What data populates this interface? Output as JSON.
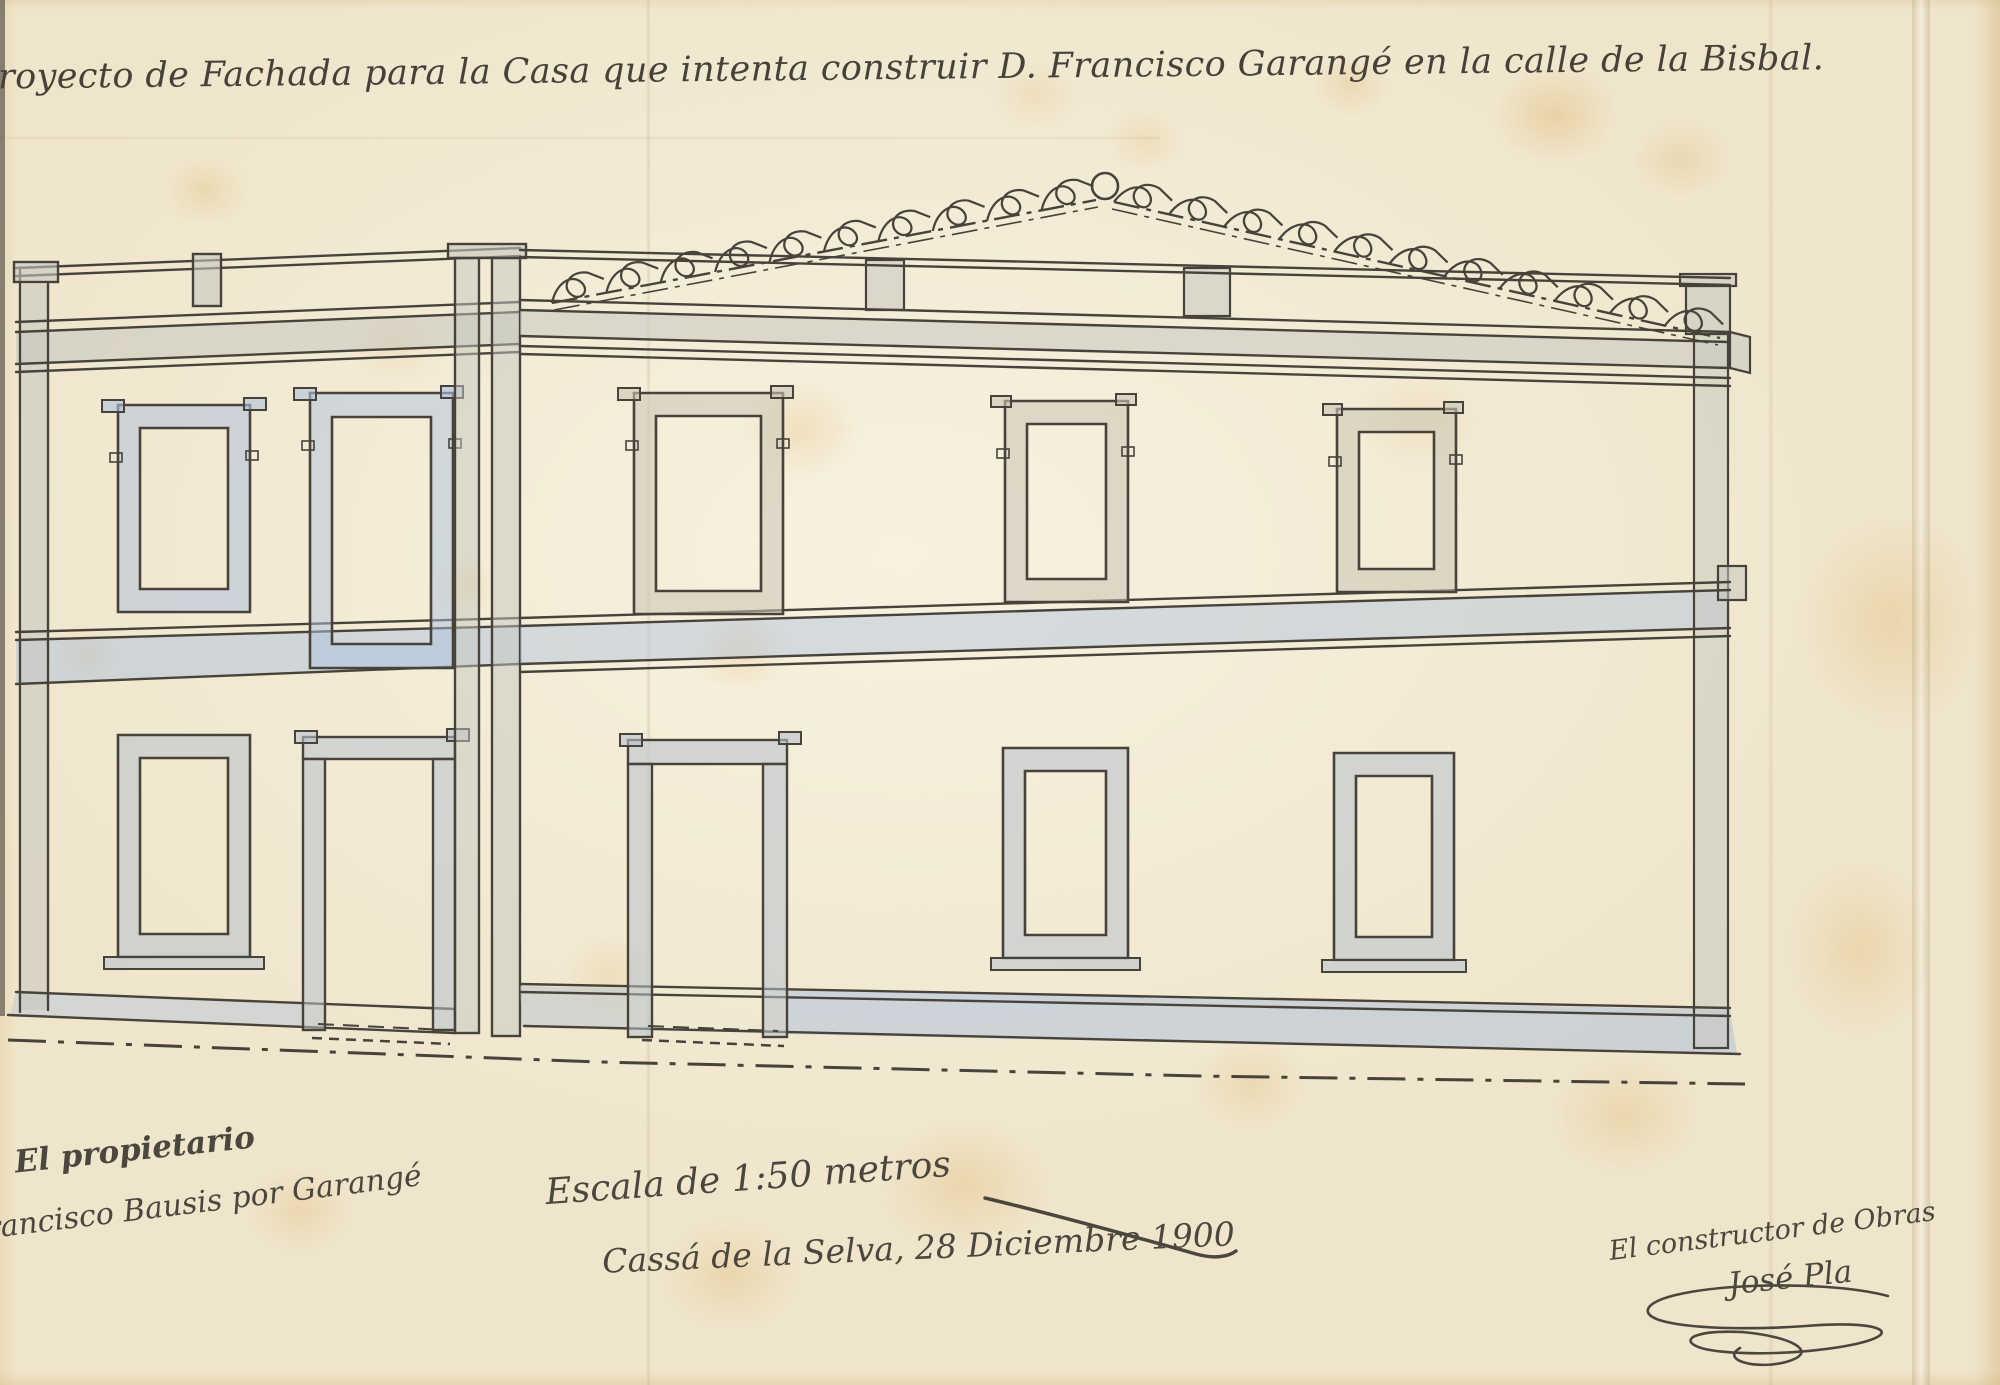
{
  "document": {
    "title": "Proyecto de Fachada para la Casa que intenta construir D. Francisco Garangé en la calle de la Bisbal.",
    "annotations": {
      "owner_role": "El propietario",
      "owner_signature": "Francisco Bausis por Garangé",
      "scale": "Escala de 1:50 metros",
      "place_date": "Cassá de la Selva, 28 Diciembre 1900",
      "builder_role": "El constructor de Obras",
      "builder_signature": "José Pla"
    },
    "colors": {
      "paper": "#efe5cb",
      "stain": "#e2bd7f",
      "ink": "#48433a",
      "wash_blue": "#aec1dd",
      "wash_grey": "#c6c7bf"
    }
  }
}
